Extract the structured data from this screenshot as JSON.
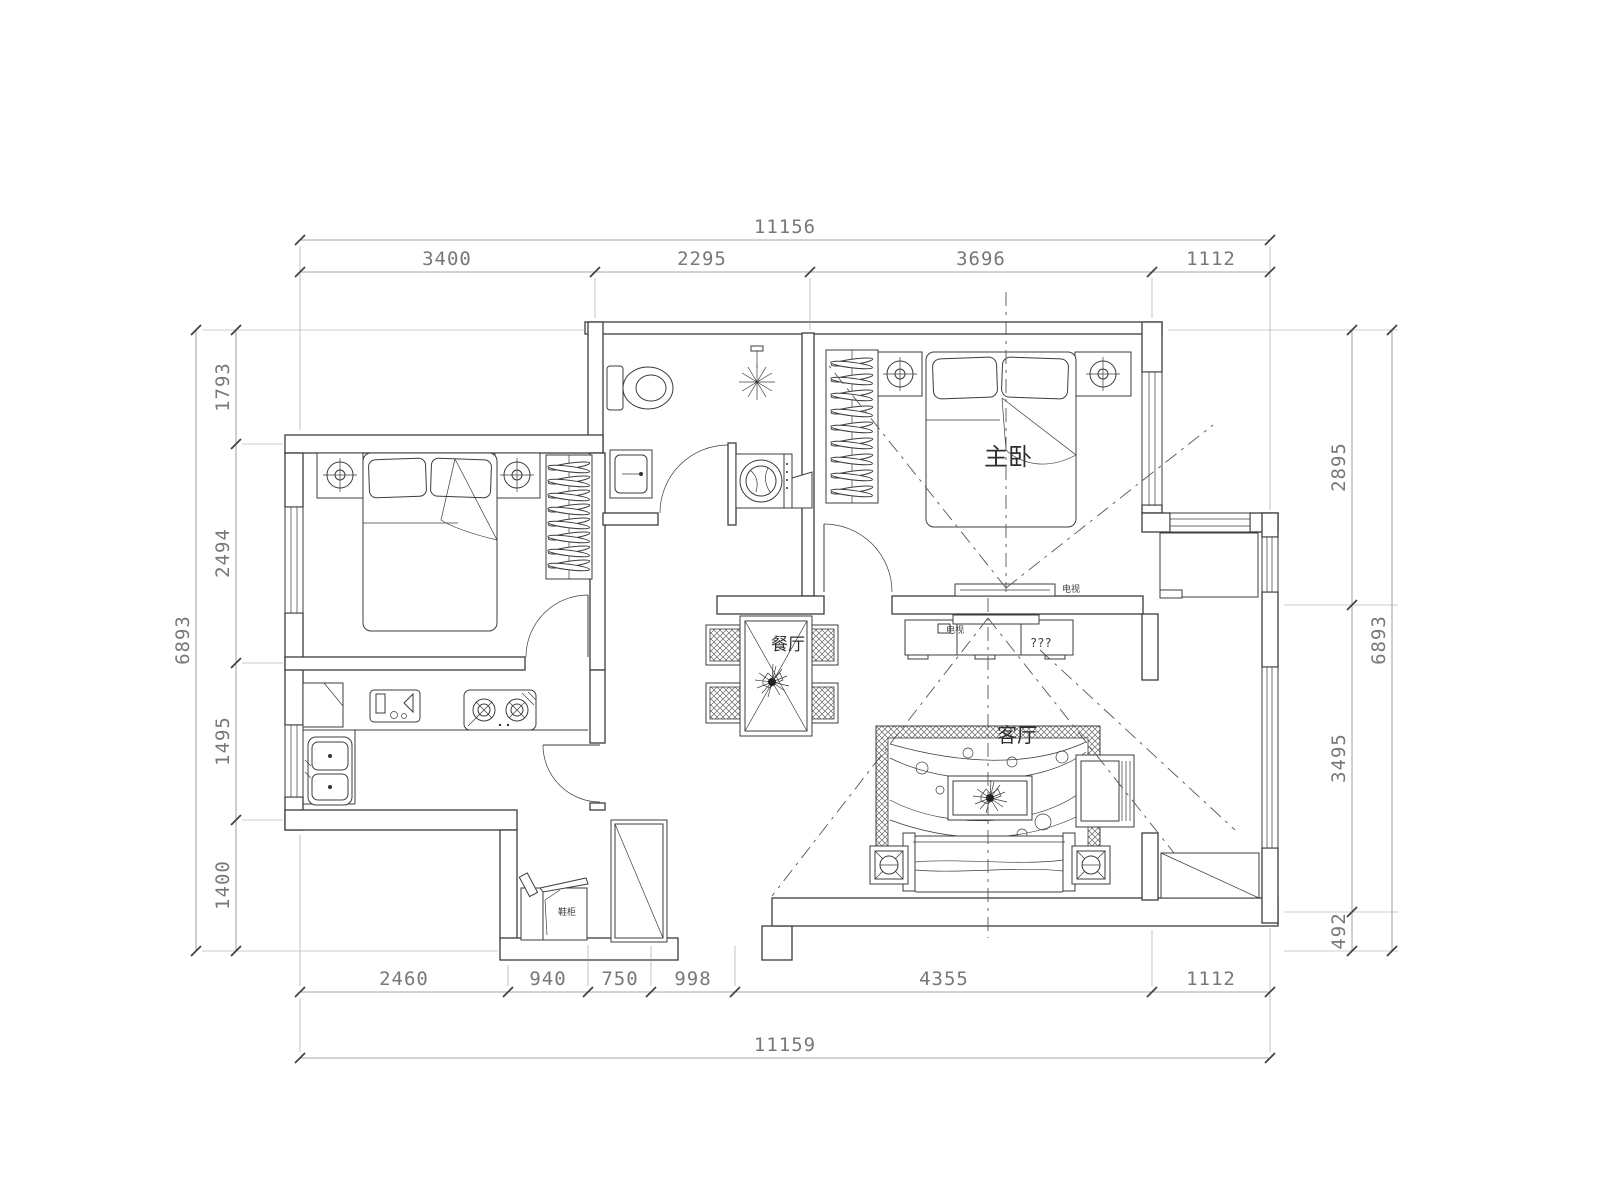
{
  "dims": {
    "top_total": "11156",
    "top_segments": [
      "3400",
      "2295",
      "3696",
      "1112"
    ],
    "bottom_segments": [
      "2460",
      "940",
      "750",
      "998",
      "4355",
      "1112"
    ],
    "bottom_total": "11159",
    "left_total": "6893",
    "left_segments": [
      "1793",
      "2494",
      "1495",
      "1400"
    ],
    "right_segments": [
      "2895",
      "3495",
      "492"
    ],
    "right_total": "6893"
  },
  "rooms": {
    "master_bedroom": "主卧",
    "dining_room": "餐厅",
    "living_room": "客厅"
  },
  "labels": {
    "tv": "电视",
    "tv_cabinet": "???",
    "shoe_cabinet": "鞋柜"
  },
  "colors": {
    "line": "#3c3c3c",
    "dim_text": "#787878",
    "background": "#ffffff"
  }
}
